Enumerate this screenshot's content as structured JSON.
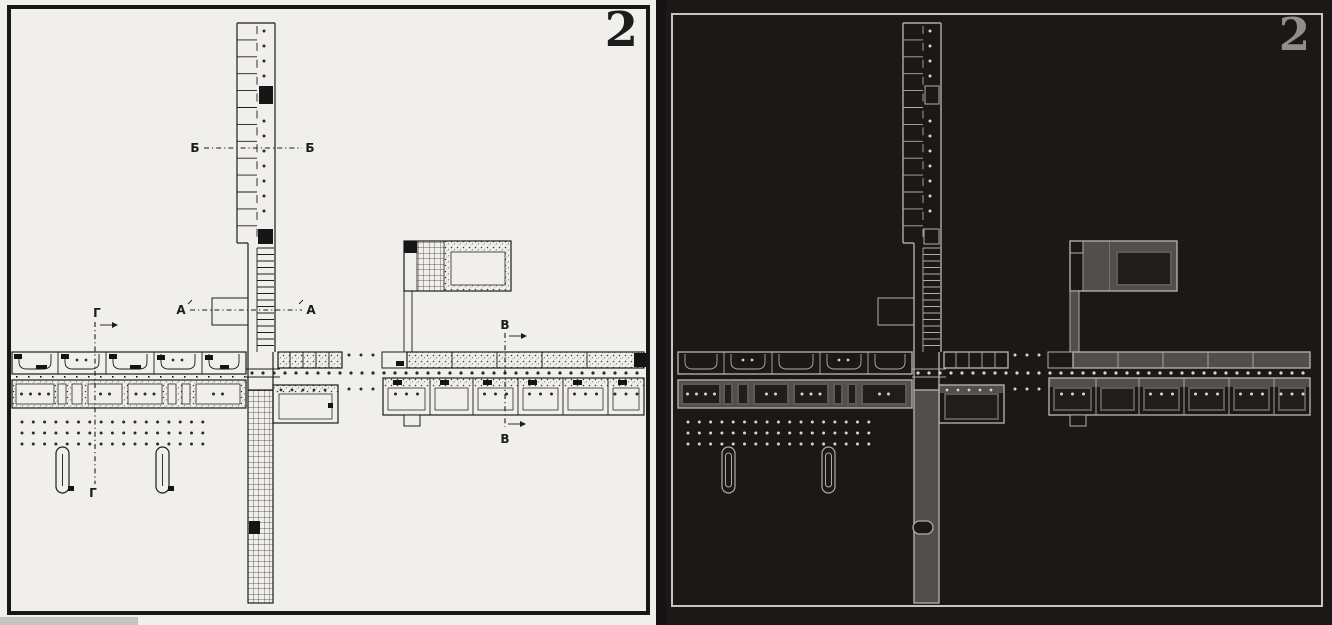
{
  "figure": {
    "left": {
      "figure_number": "2",
      "section_labels": {
        "b_left": "Б",
        "b_right": "Б",
        "a_left": "А",
        "a_right": "А",
        "v_top": "В",
        "v_bottom": "В",
        "g_top": "Г",
        "g_bottom": "Г"
      }
    },
    "right": {
      "figure_number": "2"
    }
  },
  "colors": {
    "left_background": "#f1efeb",
    "left_ink": "#1c1c1c",
    "left_block": "#161616",
    "right_background": "#1b1918",
    "right_line": "#b0ada9",
    "right_fill_gray": "#514e4c",
    "right_room_dark": "#201d1d",
    "right_dot": "#d9d6d2",
    "right_frame": "#c7c4c1",
    "right_figure_number": "#918e8b",
    "gutter": "#141212",
    "scan_bar": "#c6c4c1"
  }
}
